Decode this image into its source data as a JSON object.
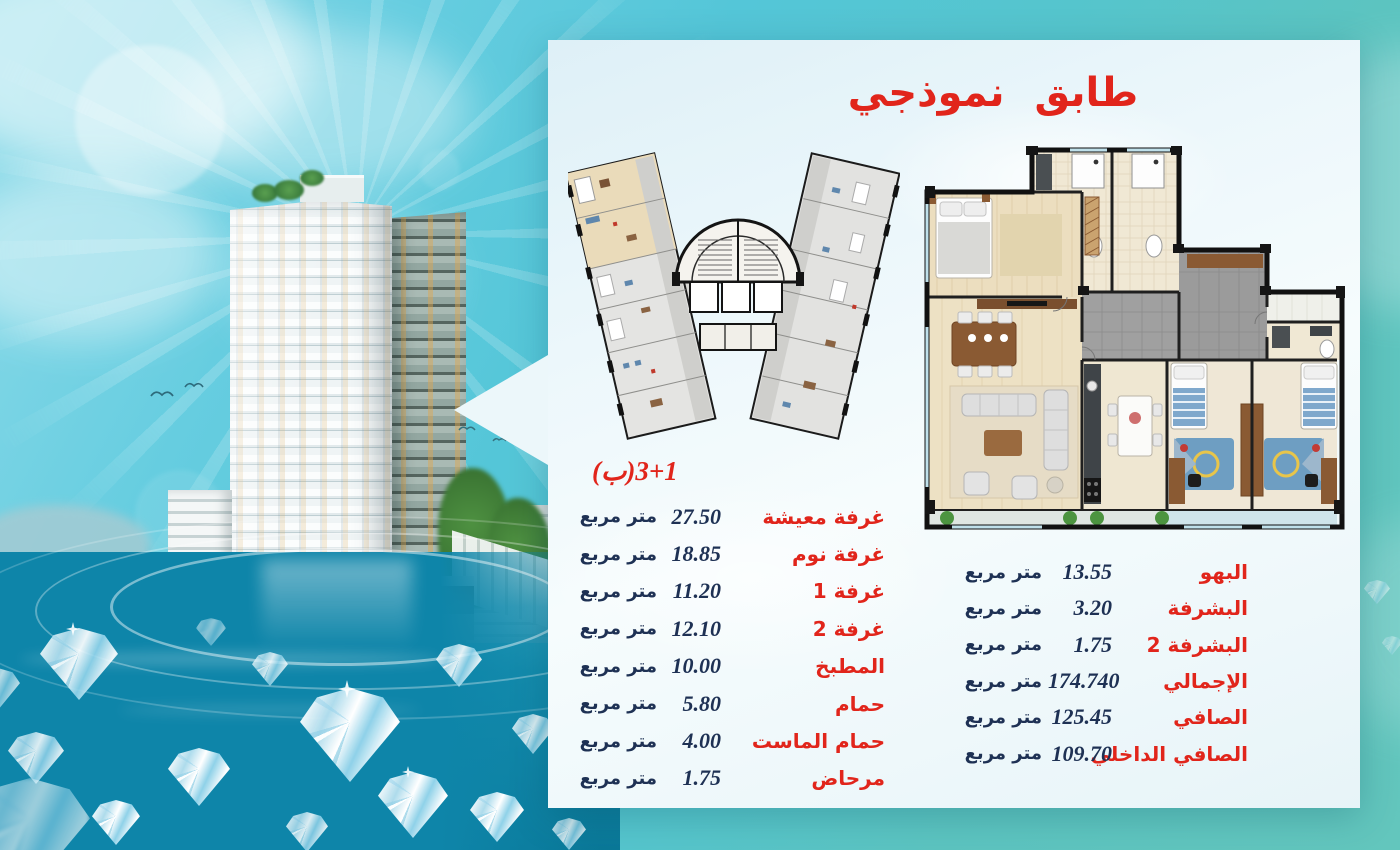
{
  "panel": {
    "title": "طابق نموذجي",
    "unit_label": "3+1(ب)"
  },
  "left_table": {
    "rows": [
      {
        "name": "غرفة معيشة",
        "value": "27.50",
        "unit": "متر مربع"
      },
      {
        "name": "غرفة نوم",
        "value": "18.85",
        "unit": "متر مربع"
      },
      {
        "name": "غرفة 1",
        "value": "11.20",
        "unit": "متر مربع"
      },
      {
        "name": "غرفة 2",
        "value": "12.10",
        "unit": "متر مربع"
      },
      {
        "name": "المطبخ",
        "value": "10.00",
        "unit": "متر مربع"
      },
      {
        "name": "حمام",
        "value": "5.80",
        "unit": "متر مربع"
      },
      {
        "name": "حمام الماست",
        "value": "4.00",
        "unit": "متر مربع"
      },
      {
        "name": "مرحاض",
        "value": "1.75",
        "unit": "متر مربع"
      }
    ]
  },
  "right_table": {
    "rows": [
      {
        "name": "البهو",
        "value": "13.55",
        "unit": "متر مربع"
      },
      {
        "name": "البشرفة",
        "value": "3.20",
        "unit": "متر مربع"
      },
      {
        "name": "البشرفة 2",
        "value": "1.75",
        "unit": "متر مربع"
      },
      {
        "name": "الإجمالي",
        "value": "174.740",
        "unit": "متر مربع"
      },
      {
        "name": "الصافي",
        "value": "125.45",
        "unit": "متر مربع"
      },
      {
        "name": "الصافي الداخلي",
        "value": "109.70",
        "unit": "متر مربع"
      }
    ]
  },
  "colors": {
    "accent_red": "#e1251b",
    "value_navy": "#1e3154",
    "panel_bg": "#ecf7fa",
    "sky_cyan": "#54c6d8",
    "teal": "#63c6bd",
    "water_deep": "#0e85a9",
    "highlight_beige": "#eadbba"
  }
}
